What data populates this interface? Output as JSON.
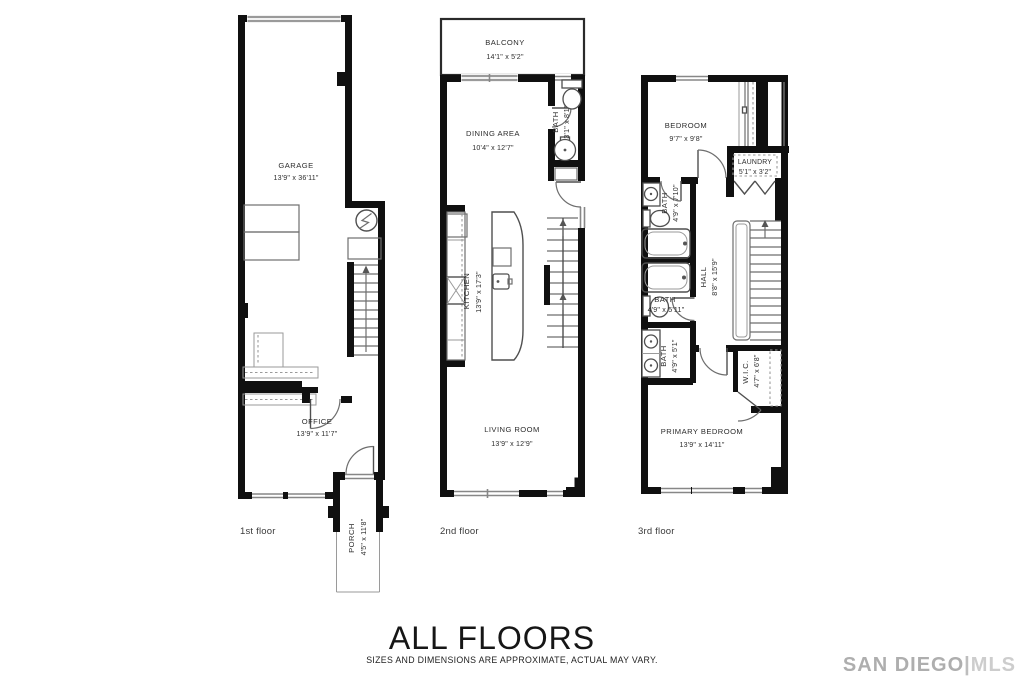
{
  "title_block": {
    "heading": "ALL FLOORS",
    "disclaimer": "SIZES AND DIMENSIONS ARE APPROXIMATE, ACTUAL MAY VARY."
  },
  "watermark": {
    "prefix": "SAN DIEGO",
    "separator": "|",
    "suffix": "MLS",
    "prefix_color": "#aeaeae",
    "separator_color": "#bdbdbd",
    "suffix_color": "#cdcdcd"
  },
  "floors": {
    "first": {
      "label": "1st floor",
      "rooms": {
        "garage": {
          "name": "GARAGE",
          "dims": "13'9\" x 36'11\""
        },
        "office": {
          "name": "OFFICE",
          "dims": "13'9\" x 11'7\""
        },
        "porch": {
          "name": "PORCH",
          "dims": "4'5\" x 11'8\""
        }
      }
    },
    "second": {
      "label": "2nd floor",
      "rooms": {
        "balcony": {
          "name": "BALCONY",
          "dims": "14'1\" x 5'2\""
        },
        "dining_area": {
          "name": "DINING AREA",
          "dims": "10'4\" x 12'7\""
        },
        "bath": {
          "name": "BATH",
          "dims": "3'1\" x 8'1\""
        },
        "kitchen": {
          "name": "KITCHEN",
          "dims": "13'9\" x 17'3\""
        },
        "living_room": {
          "name": "LIVING ROOM",
          "dims": "13'9\" x 12'9\""
        }
      }
    },
    "third": {
      "label": "3rd floor",
      "rooms": {
        "bedroom": {
          "name": "BEDROOM",
          "dims": "9'7\" x 9'8\""
        },
        "laundry": {
          "name": "LAUNDRY",
          "dims": "5'1\" x 3'2\""
        },
        "bath_upper": {
          "name": "BATH",
          "dims": "4'9\" x 7'10\""
        },
        "bath_middle": {
          "name": "BATH",
          "dims": "4'9\" x 5'11\""
        },
        "bath_lower": {
          "name": "BATH",
          "dims": "4'9\" x 5'1\""
        },
        "hall": {
          "name": "HALL",
          "dims": "8'8\" x 15'9\""
        },
        "wic": {
          "name": "W.I.C.",
          "dims": "4'7\" x 6'8\""
        },
        "primary_bedroom": {
          "name": "PRIMARY BEDROOM",
          "dims": "13'9\" x 14'11\""
        }
      }
    }
  }
}
